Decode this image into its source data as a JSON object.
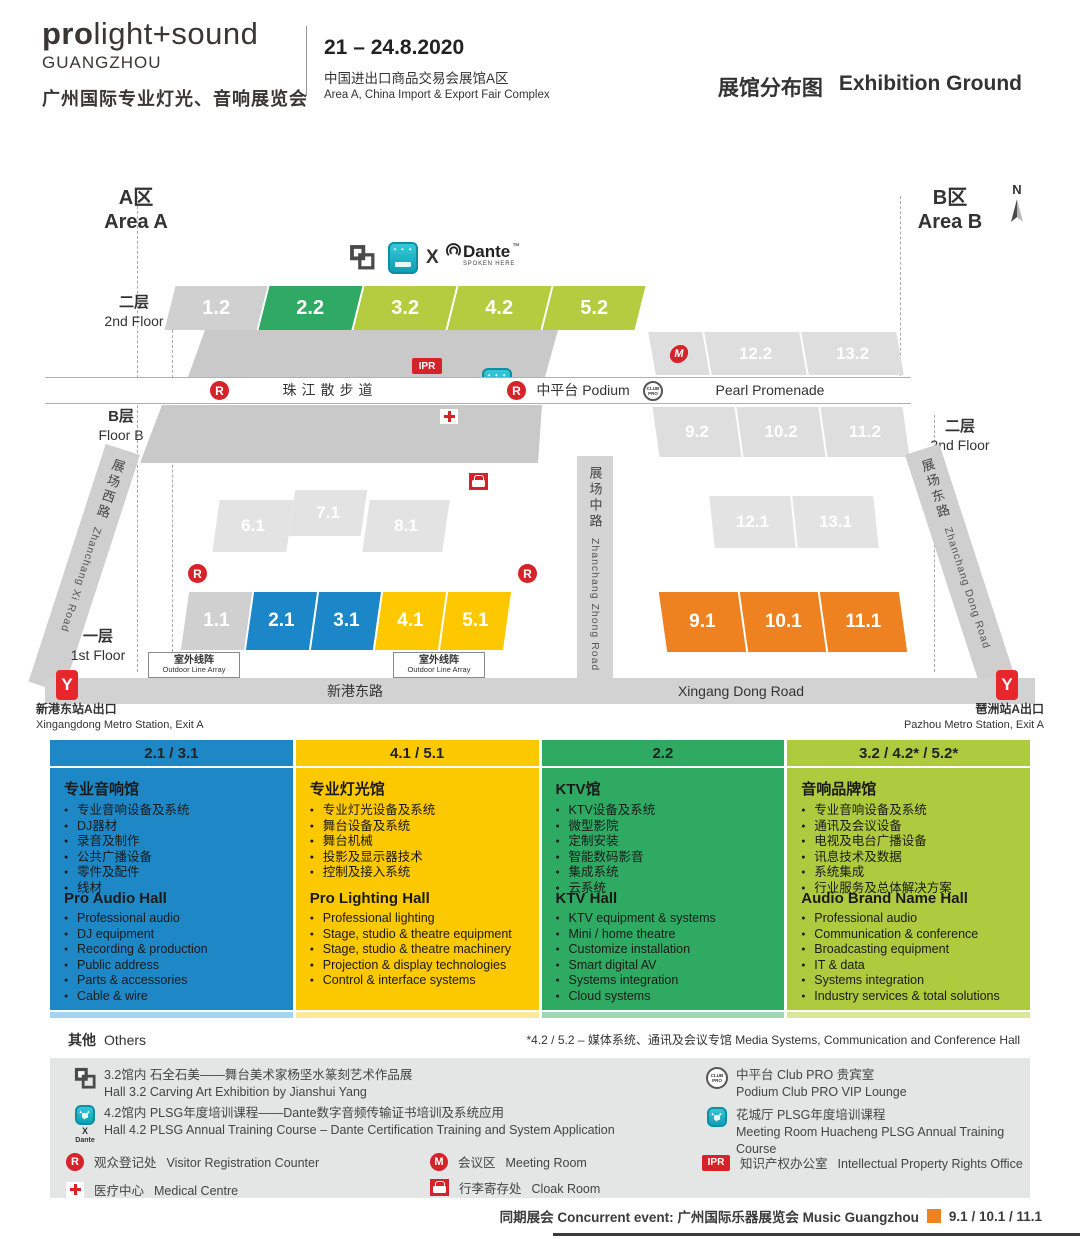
{
  "header": {
    "brand_bold": "pro",
    "brand_light": "light+sound",
    "brand_city": "GUANGZHOU",
    "brand_cn": "广州国际专业灯光、音响展览会",
    "dates": "21 – 24.8.2020",
    "venue_cn": "中国进出口商品交易会展馆A区",
    "venue_en": "Area A, China Import & Export Fair Complex",
    "title_cn": "展馆分布图",
    "title_en": "Exhibition Ground"
  },
  "map": {
    "area_a_cn": "A区",
    "area_a_en": "Area A",
    "area_b_cn": "B区",
    "area_b_en": "Area B",
    "compass_n": "N",
    "x_label": "X",
    "dante": {
      "name": "Dante",
      "tm": "™",
      "sub": "SPOKEN HERE"
    },
    "floors": {
      "f2_cn": "二层",
      "f2_en": "2nd Floor",
      "fb_cn": "B层",
      "fb_en": "Floor B",
      "f2r_cn": "二层",
      "f2r_en": "2nd Floor",
      "f1_cn": "一层",
      "f1_en": "1st Floor"
    },
    "halls": {
      "floor2": [
        "1.2",
        "2.2",
        "3.2",
        "4.2",
        "5.2"
      ],
      "podium_upper": [
        "12.2",
        "13.2"
      ],
      "floorb_right": [
        "9.2",
        "10.2",
        "11.2"
      ],
      "mid_left": [
        "6.1",
        "7.1",
        "8.1"
      ],
      "mid_right": [
        "12.1",
        "13.1"
      ],
      "floor1": [
        "1.1",
        "2.1",
        "3.1",
        "4.1",
        "5.1"
      ],
      "floor1_right": [
        "9.1",
        "10.1",
        "11.1"
      ]
    },
    "badges": {
      "r": "R",
      "m": "M",
      "ipr": "IPR",
      "club_pro": "CLUB PRO",
      "metro": "Y"
    },
    "promenade": {
      "cn": "珠江散步道",
      "podium": "中平台 Podium",
      "en": "Pearl Promenade"
    },
    "roads": {
      "west_cn": "展场西路",
      "west_en": "Zhanchang Xi Road",
      "mid_cn": "展场中路",
      "mid_en": "Zhanchang Zhong Road",
      "east_cn": "展场东路",
      "east_en": "Zhanchang Dong Road",
      "south_cn": "新港东路",
      "south_en": "Xingang Dong Road"
    },
    "outdoor_array": {
      "cn": "室外线阵",
      "en": "Outdoor Line Array"
    },
    "metro_left": {
      "cn": "新港东站A出口",
      "en": "Xingangdong Metro Station, Exit A"
    },
    "metro_right": {
      "cn": "琶洲站A出口",
      "en": "Pazhou Metro Station, Exit A"
    }
  },
  "legend": {
    "columns": [
      {
        "header": "2.1 / 3.1",
        "cn_title": "专业音响馆",
        "cn_items": [
          "专业音响设备及系统",
          "DJ器材",
          "录音及制作",
          "公共广播设备",
          "零件及配件",
          "线材"
        ],
        "en_title": "Pro Audio Hall",
        "en_items": [
          "Professional audio",
          "DJ equipment",
          "Recording & production",
          "Public address",
          "Parts & accessories",
          "Cable & wire"
        ]
      },
      {
        "header": "4.1 / 5.1",
        "cn_title": "专业灯光馆",
        "cn_items": [
          "专业灯光设备及系统",
          "舞台设备及系统",
          "舞台机械",
          "投影及显示器技术",
          "控制及接入系统"
        ],
        "en_title": "Pro Lighting Hall",
        "en_items": [
          "Professional lighting",
          "Stage, studio & theatre equipment",
          "Stage, studio & theatre machinery",
          "Projection & display technologies",
          "Control & interface systems"
        ]
      },
      {
        "header": "2.2",
        "cn_title": "KTV馆",
        "cn_items": [
          "KTV设备及系统",
          "微型影院",
          "定制安装",
          "智能数码影音",
          "集成系统",
          "云系统"
        ],
        "en_title": "KTV Hall",
        "en_items": [
          "KTV equipment & systems",
          "Mini / home theatre",
          "Customize installation",
          "Smart digital AV",
          "Systems integration",
          "Cloud systems"
        ]
      },
      {
        "header": "3.2 / 4.2* / 5.2*",
        "cn_title": "音响品牌馆",
        "cn_items": [
          "专业音响设备及系统",
          "通讯及会议设备",
          "电视及电台广播设备",
          "讯息技术及数据",
          "系统集成",
          "行业服务及总体解决方案"
        ],
        "en_title": "Audio Brand Name Hall",
        "en_items": [
          "Professional audio",
          "Communication & conference",
          "Broadcasting equipment",
          "IT & data",
          "Systems integration",
          "Industry services & total solutions"
        ]
      }
    ]
  },
  "others": {
    "cn": "其他",
    "en": "Others",
    "footnote": "*4.2 / 5.2 – 媒体系统、通讯及会议专馆 Media Systems, Communication and Conference Hall"
  },
  "notes": {
    "left": [
      {
        "line1": "3.2馆内  石全石美——舞台美术家杨坚水篆刻艺术作品展",
        "line2": "Hall 3.2  Carving Art Exhibition by Jianshui Yang"
      },
      {
        "line1": "4.2馆内  PLSG年度培训课程——Dante数字音频传输证书培训及系统应用",
        "line2": "Hall 4.2  PLSG Annual Training Course – Dante Certification Training and System Application"
      }
    ],
    "right": [
      {
        "line1": "中平台 Club PRO 贵宾室",
        "line2": "Podium Club PRO VIP Lounge"
      },
      {
        "line1": "花城厅  PLSG年度培训课程",
        "line2": "Meeting Room Huacheng PLSG Annual Training Course"
      }
    ]
  },
  "facilities": [
    {
      "cn": "观众登记处",
      "en": "Visitor Registration Counter"
    },
    {
      "cn": "会议区",
      "en": "Meeting Room"
    },
    {
      "cn": "知识产权办公室",
      "en": "Intellectual Property Rights Office"
    },
    {
      "cn": "医疗中心",
      "en": "Medical Centre"
    },
    {
      "cn": "行李寄存处",
      "en": "Cloak Room"
    }
  ],
  "footer": {
    "concurrent": "同期展会 Concurrent event: 广州国际乐器展览会 Music Guangzhou",
    "orange_halls": "9.1 / 10.1 / 11.1"
  },
  "colors": {
    "blue": "#1b87c9",
    "yellow": "#fdc800",
    "green": "#2fa963",
    "lime": "#b5cc40",
    "orange": "#ee8220",
    "red": "#d6232a",
    "teal": "#19b6c9",
    "gray_hall": "#d0d0d0"
  }
}
